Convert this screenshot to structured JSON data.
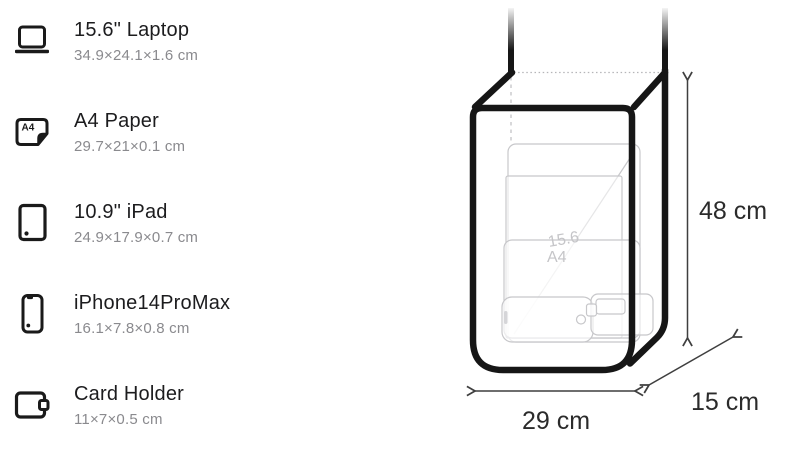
{
  "item_list": {
    "items": [
      {
        "name": "15.6\" Laptop",
        "dimensions": "34.9×24.1×1.6 cm",
        "icon": "laptop-icon"
      },
      {
        "name": "A4 Paper",
        "dimensions": "29.7×21×0.1 cm",
        "icon": "a4-paper-icon"
      },
      {
        "name": "10.9\" iPad",
        "dimensions": "24.9×17.9×0.7 cm",
        "icon": "ipad-icon"
      },
      {
        "name": "iPhone14ProMax",
        "dimensions": "16.1×7.8×0.8 cm",
        "icon": "iphone-icon"
      },
      {
        "name": "Card Holder",
        "dimensions": "11×7×0.5 cm",
        "icon": "card-holder-icon"
      }
    ]
  },
  "diagram": {
    "height_label": "48 cm",
    "width_label": "29 cm",
    "depth_label": "15 cm",
    "ghost_labels": {
      "laptop": "15.6",
      "a4": "A4"
    },
    "a4_icon_text": "A4",
    "colors": {
      "outline": "#161616",
      "ghost_stroke": "#c7c7ca",
      "dotted_edge": "#b5b5b8",
      "arrow": "#3f3f3f",
      "dimension_text": "#2b2b2b",
      "item_title": "#1c1c1e",
      "item_subtitle": "#8a8a8e"
    }
  }
}
